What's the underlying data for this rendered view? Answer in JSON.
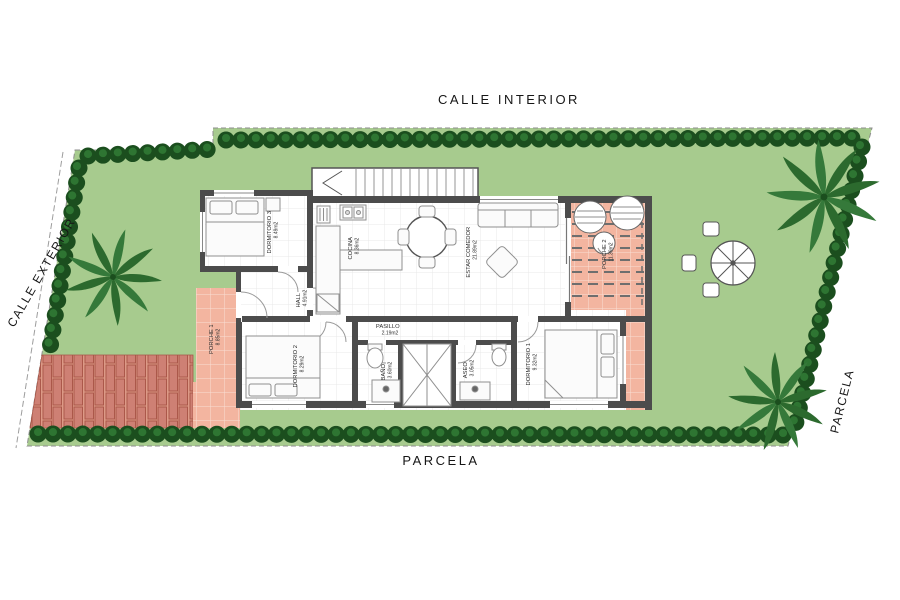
{
  "streets": {
    "top": "CALLE INTERIOR",
    "left": "CALLE EXTERIOR",
    "bottom": "PARCELA",
    "right": "PARCELA"
  },
  "rooms": {
    "dormitorio3": {
      "name": "DORMITORIO 3",
      "area": "8.49m2"
    },
    "cocina": {
      "name": "COCINA",
      "area": "8.36m2"
    },
    "estar_comedor": {
      "name": "ESTAR COMEDOR",
      "area": "21.89m2"
    },
    "porche2": {
      "name": "PORCHE 2",
      "area": "11.39m2"
    },
    "hall": {
      "name": "HALL",
      "area": "4.91m2"
    },
    "pasillo": {
      "name": "PASILLO",
      "area": "2.19m2"
    },
    "dormitorio2": {
      "name": "DORMITORIO 2",
      "area": "8.29m2"
    },
    "bano": {
      "name": "BAÑO",
      "area": "3.60m2"
    },
    "aseo": {
      "name": "ASEO",
      "area": "3.05m2"
    },
    "dormitorio1": {
      "name": "DORMITORIO 1",
      "area": "9.32m2"
    },
    "porche1": {
      "name": "PORCHE 1",
      "area": "8.85m2"
    }
  },
  "colors": {
    "lawn": "#a7cb8e",
    "hedge": "#1b4e1e",
    "hedge_light": "#2e7532",
    "paving_pink": "#f3b5a0",
    "brick": "#cf8175",
    "wall": "#4c4c4c",
    "palm": "#2c6a2e"
  }
}
